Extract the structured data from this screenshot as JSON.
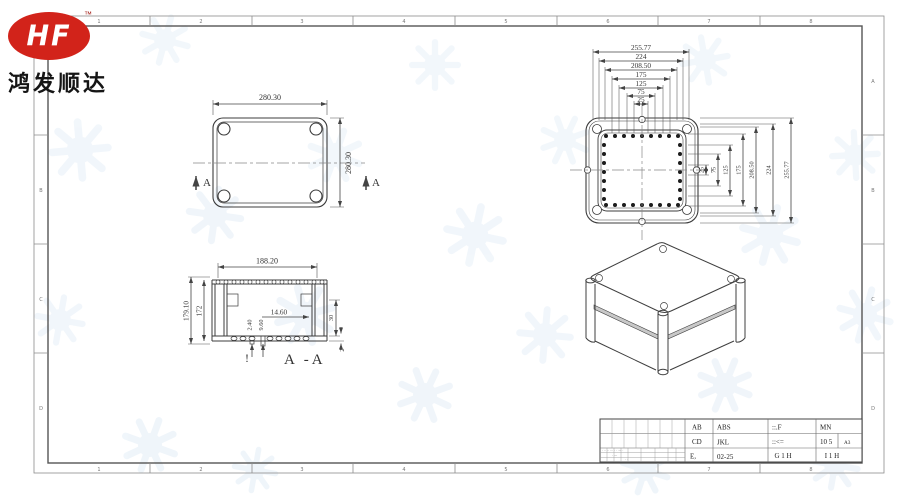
{
  "logo": {
    "brand": "HF",
    "tm": "™",
    "company": "鸿发顺达"
  },
  "frame": {
    "cols": [
      "1",
      "2",
      "3",
      "4",
      "5",
      "6",
      "7",
      "8"
    ],
    "rows": [
      "A",
      "B",
      "C",
      "D"
    ]
  },
  "top_view": {
    "dim_width": "280.30",
    "dim_height": "280.30",
    "section_letter": "A"
  },
  "lid_view": {
    "top_dims": [
      "255.77",
      "224",
      "208.50",
      "175",
      "125",
      "75",
      "25"
    ],
    "right_dims": [
      "25",
      "75",
      "125",
      "175",
      "208.50",
      "224",
      "255.77"
    ]
  },
  "section_view": {
    "dim_width": "188.20",
    "dim_height_outer": "179.10",
    "dim_height_inner": "172",
    "dim_hole": "14.60",
    "dim_boss_small": "2.40",
    "dim_boss_large": "9.60",
    "dim_step": "30",
    "dim_wall": "2",
    "mark": "!",
    "label": "A -A"
  },
  "title_block": {
    "r1c1": "AB",
    "r1c2": "ABS",
    "r1c3": "::.F",
    "r1c4": "MN",
    "r2c1": "CD",
    "r2c2": "JKL",
    "r2c3": "::<=",
    "r2c4": "10 5",
    "r2c5": "A3",
    "r3c1": "E,",
    "r3c2": "02-25",
    "r3c3": "G 1 H",
    "r3c4": "I 1 H",
    "left_marks": [
      "· ·· ·· ··· · · — ·",
      "· —",
      "· ·"
    ]
  }
}
